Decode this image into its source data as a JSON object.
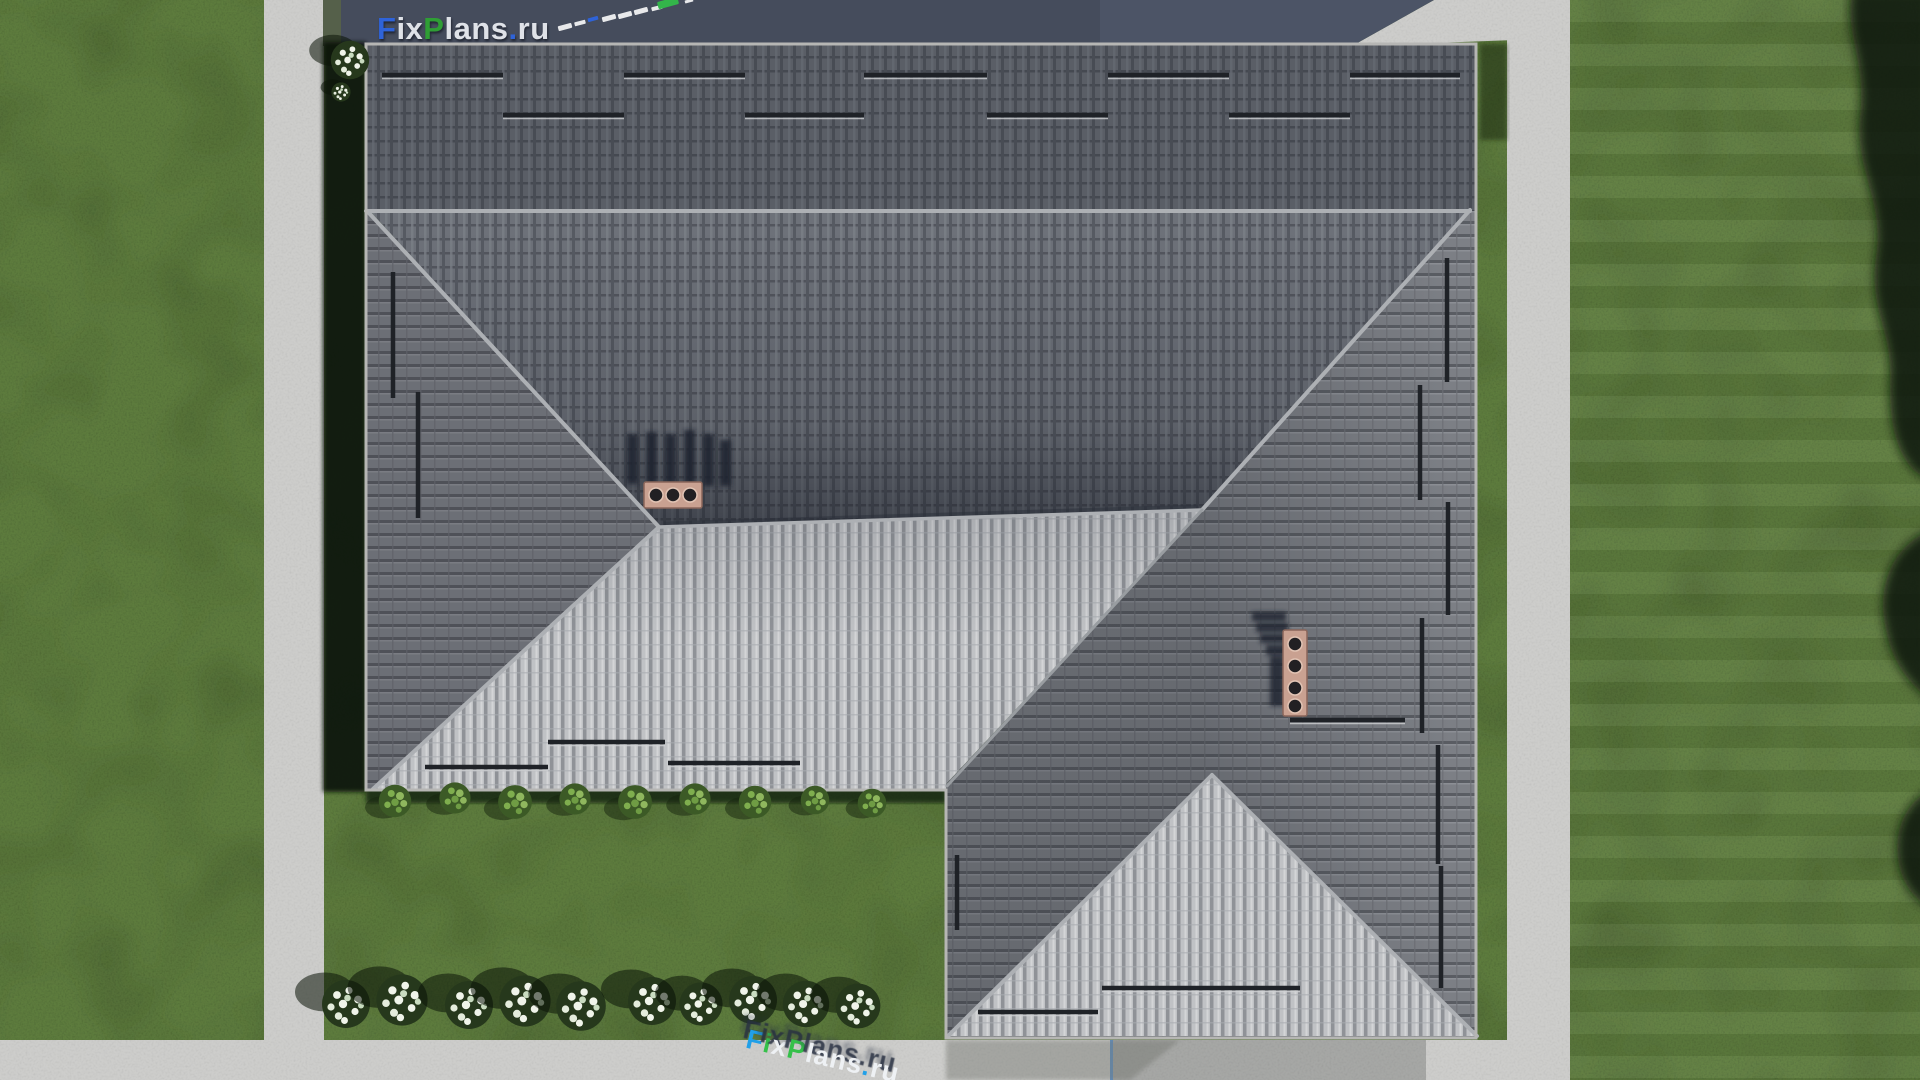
{
  "branding": {
    "top_watermark": {
      "text": "FixPlans.ru",
      "parts": [
        {
          "text": "F",
          "color": "#2f63d8"
        },
        {
          "text": "ix",
          "color": "#dfe2e8"
        },
        {
          "text": "P",
          "color": "#2f9e35"
        },
        {
          "text": "lans",
          "color": "#dfe2e8"
        },
        {
          "text": ".",
          "color": "#2f63d8"
        },
        {
          "text": "ru",
          "color": "#dfe2e8"
        }
      ]
    },
    "ground_logo": {
      "text": "FixPlans.ru",
      "parts": [
        {
          "text": "F",
          "color": "#21a0e8"
        },
        {
          "text": "i",
          "color": "#35c04a"
        },
        {
          "text": "x",
          "color": "#eef1f4"
        },
        {
          "text": "P",
          "color": "#35c04a"
        },
        {
          "text": "lans",
          "color": "#eef1f4"
        },
        {
          "text": ".",
          "color": "#21a0e8"
        },
        {
          "text": "ru",
          "color": "#eef1f4"
        }
      ]
    }
  },
  "scene": {
    "description": "Top-down aerial 3D render of a hip-roof house with lawn, concrete walkways and an access road",
    "house": {
      "roof_tile_dark": "#6d7179",
      "roof_tile_medium": "#7e8187",
      "roof_tile_light": "#c0c2c5",
      "ridge_color": "#adb0b4",
      "fascia_color": "#b6b6b4",
      "snow_guard_color": "#1f2227",
      "chimney_cap_color": "#c9a191",
      "chimneys": [
        {
          "position": "south-slope",
          "flues": 3
        },
        {
          "position": "east-slope",
          "flues": 4
        }
      ]
    },
    "landscape": {
      "grass_color": "#5d7b3d",
      "bush_green": "#3c5a26",
      "flower_color": "#f0f4ea",
      "shadow_color": "#0c1507",
      "flower_bush_count": 10,
      "green_bush_count": 9
    },
    "paths": {
      "walkway_color": "#cdcdcb",
      "driveway_color": "#a6a7a5",
      "road_color": "#454c5c",
      "dash_colors": [
        "#e8e9eb",
        "#e8e9eb",
        "#2f63d8",
        "#e8e9eb",
        "#e8e9eb",
        "#e8e9eb",
        "#e8e9eb",
        "#33b54a",
        "#e8e9eb"
      ]
    }
  }
}
